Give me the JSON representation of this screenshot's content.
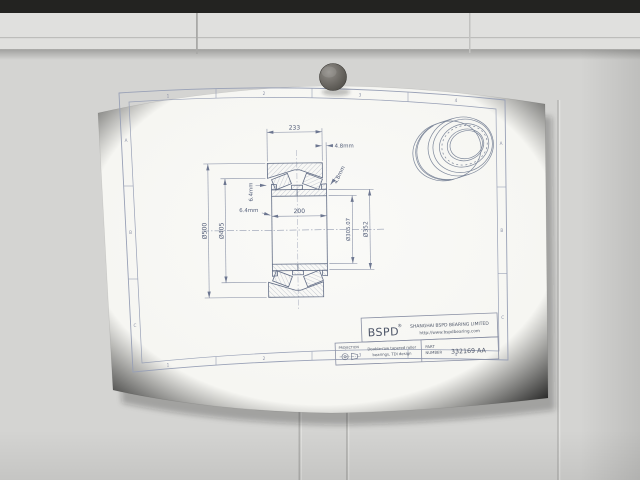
{
  "sheet": {
    "zones": {
      "top": [
        "1",
        "2",
        "3",
        "4"
      ],
      "bottom": [
        "1",
        "2",
        "3",
        "4"
      ],
      "left": [
        "A",
        "B",
        "C"
      ],
      "right": [
        "A",
        "B",
        "C"
      ]
    },
    "dimensions": {
      "overall_width": "233",
      "inner_width": "200",
      "face_offset_right": "4.8mm",
      "face_offset_right_angled": "4.8mm",
      "face_offset_left_vertical": "6.4mm",
      "face_offset_left": "6.4mm",
      "outer_diameter": "Ø500",
      "shoulder_diameter": "Ø405",
      "bore_diameter": "Ø305.07",
      "rib_diameter": "Ø352"
    },
    "title_block": {
      "brand": "BSPD",
      "registered_mark": "®",
      "company": "SHANGHAI BSPD BEARING LIMITED",
      "website": "http://www.bspdbearing.com",
      "projection_label": "PROJECTION",
      "description_line1": "Double-row tapered roller",
      "description_line2": "bearings, TDI design",
      "part_label_line1": "PART",
      "part_label_line2": "NUMBER",
      "part_number": "332169 AA"
    }
  }
}
